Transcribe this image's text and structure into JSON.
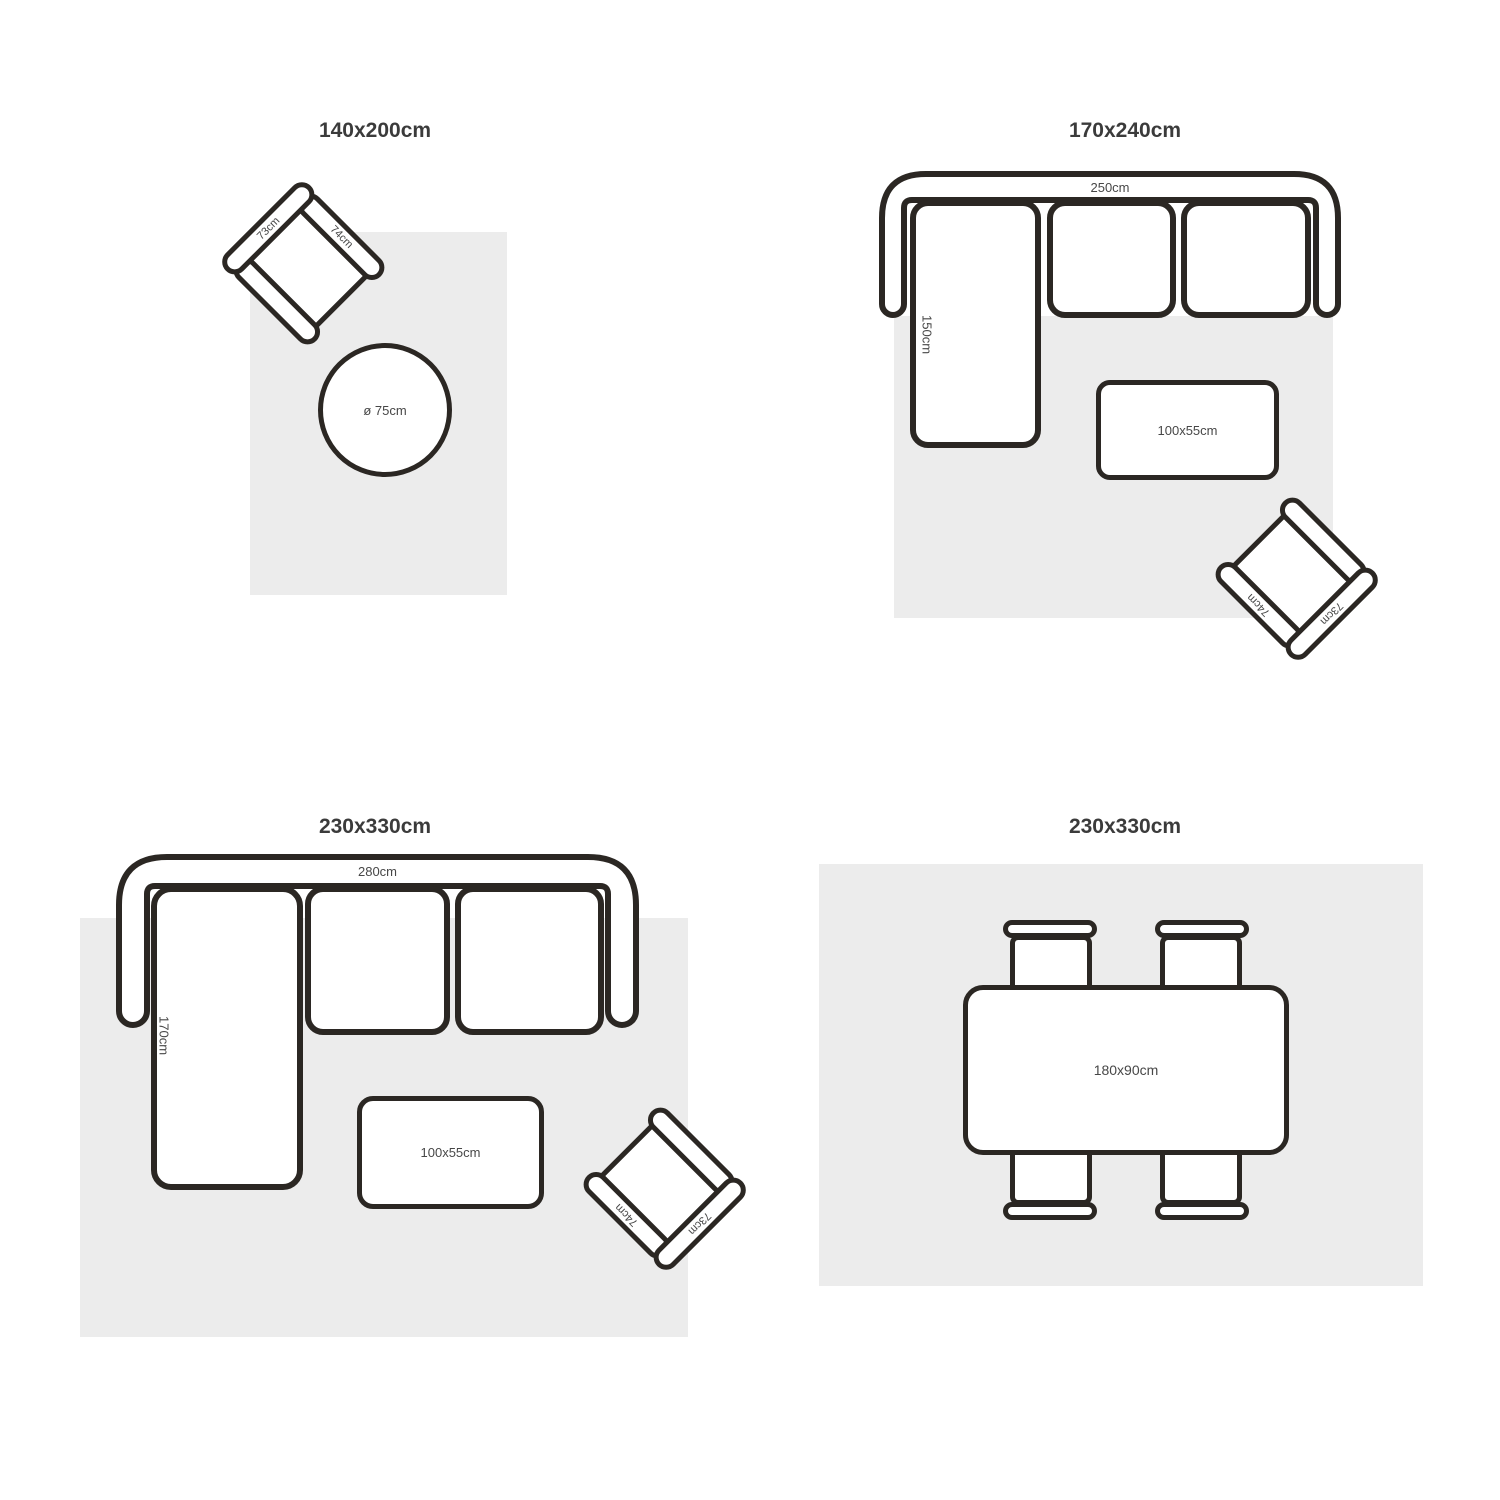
{
  "colors": {
    "outline": "#2b2723",
    "rug": "#ececec",
    "title_text": "#3b3b3b",
    "label_text": "#474747",
    "background": "#ffffff"
  },
  "panels": {
    "p1": {
      "title": "140x200cm",
      "armchair": {
        "back": "73cm",
        "arm": "74cm"
      },
      "round_table": "ø 75cm"
    },
    "p2": {
      "title": "170x240cm",
      "sofa": {
        "width": "250cm",
        "depth": "150cm"
      },
      "coffee_table": "100x55cm",
      "armchair": {
        "back": "73cm",
        "arm": "74cm"
      }
    },
    "p3": {
      "title": "230x330cm",
      "sofa": {
        "width": "280cm",
        "depth": "170cm"
      },
      "coffee_table": "100x55cm",
      "armchair": {
        "back": "73cm",
        "arm": "74cm"
      }
    },
    "p4": {
      "title": "230x330cm",
      "dining_table": "180x90cm"
    }
  }
}
